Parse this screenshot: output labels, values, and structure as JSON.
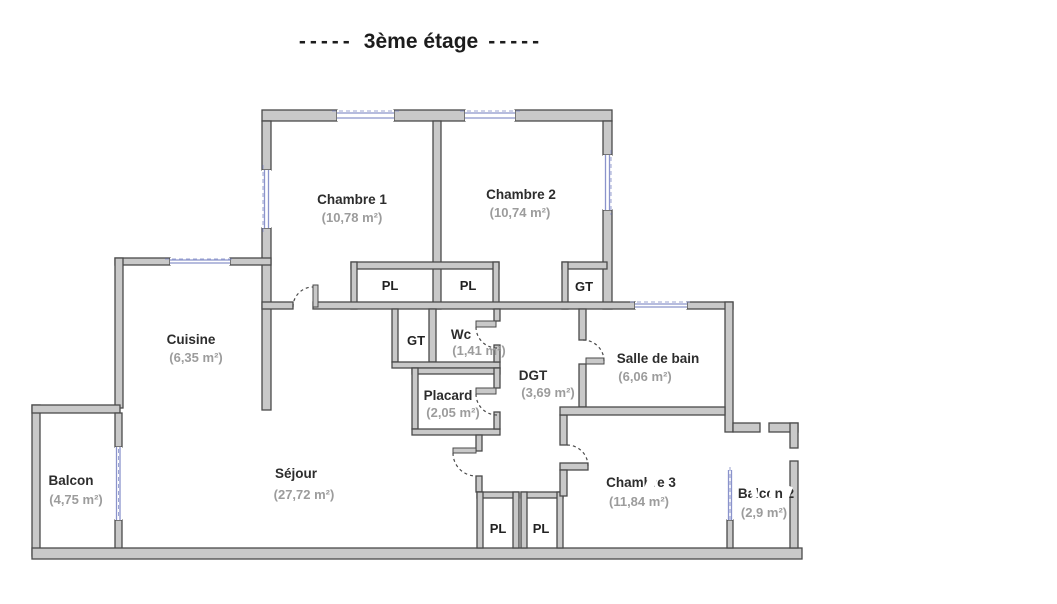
{
  "title": {
    "prefix": "-----",
    "text": "3ème étage",
    "suffix": "-----"
  },
  "floor_plan": {
    "rooms": [
      {
        "name": "Chambre 1",
        "area": "(10,78 m²)"
      },
      {
        "name": "Chambre 2",
        "area": "(10,74 m²)"
      },
      {
        "name": "Cuisine",
        "area": "(6,35 m²)"
      },
      {
        "name": "Wc",
        "area": "(1,41 m²)"
      },
      {
        "name": "DGT",
        "area": "(3,69 m²)"
      },
      {
        "name": "Salle de bain",
        "area": "(6,06 m²)"
      },
      {
        "name": "Placard",
        "area": "(2,05 m²)"
      },
      {
        "name": "Séjour",
        "area": "(27,72 m²)"
      },
      {
        "name": "Balcon",
        "area": "(4,75 m²)"
      },
      {
        "name": "Chambre 3",
        "area": "(11,84 m²)"
      },
      {
        "name": "Balcon 2",
        "area": "(2,9 m²)"
      }
    ],
    "closets": [
      {
        "label": "PL"
      },
      {
        "label": "PL"
      },
      {
        "label": "GT"
      },
      {
        "label": "GT"
      },
      {
        "label": "PL"
      },
      {
        "label": "PL"
      }
    ],
    "colors": {
      "wall_fill": "#c9c9c9",
      "wall_stroke": "#4a4a4a",
      "window_blue": "#8a93cb",
      "room_name": "#2d2d2d",
      "room_area": "#9c9c9c"
    }
  }
}
